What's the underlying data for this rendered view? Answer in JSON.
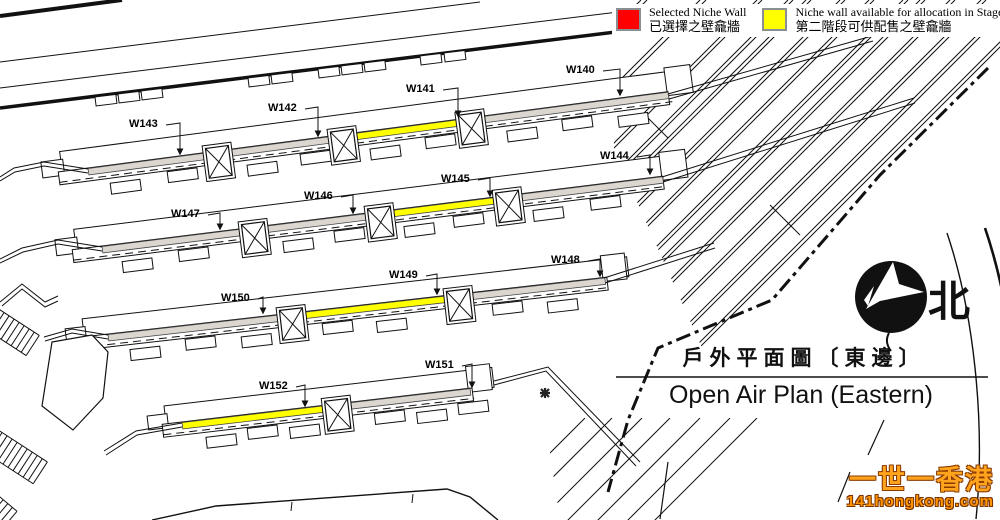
{
  "legend": {
    "items": [
      {
        "name": "selected",
        "color": "#ff0000",
        "label_en": "Selected Niche Wall",
        "label_zh": "已選擇之壁龕牆"
      },
      {
        "name": "stage2-available",
        "color": "#ffff00",
        "label_en": "Niche wall available for allocation in Stage II",
        "label_zh": "第二階段可供配售之壁龕牆"
      }
    ]
  },
  "compass": {
    "north_label": "北"
  },
  "title": {
    "zh": "戶外平面圖〔東邊〕",
    "en": "Open Air Plan (Eastern)"
  },
  "watermark": {
    "line1": "一世一香港",
    "line2": "141hongkong.com"
  },
  "plan": {
    "walls": [
      {
        "id": "W140",
        "status": "none"
      },
      {
        "id": "W141",
        "status": "stage2-available"
      },
      {
        "id": "W142",
        "status": "none"
      },
      {
        "id": "W143",
        "status": "none"
      },
      {
        "id": "W144",
        "status": "none"
      },
      {
        "id": "W145",
        "status": "stage2-available"
      },
      {
        "id": "W146",
        "status": "none"
      },
      {
        "id": "W147",
        "status": "none"
      },
      {
        "id": "W148",
        "status": "none"
      },
      {
        "id": "W149",
        "status": "stage2-available"
      },
      {
        "id": "W150",
        "status": "none"
      },
      {
        "id": "W151",
        "status": "none"
      },
      {
        "id": "W152",
        "status": "stage2-available"
      }
    ]
  },
  "colors": {
    "selected": "#ff0000",
    "stage2_available": "#ffff00",
    "wall_fill": "#dbd6cf"
  }
}
